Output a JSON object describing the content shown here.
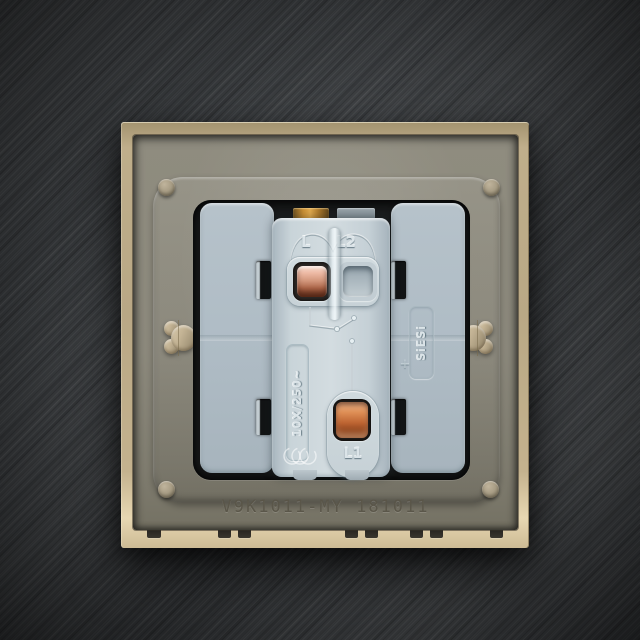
{
  "scene": {
    "description": "Rear view of a single 10A wall switch mechanism fitted in a champagne-gold face plate, photographed on dark brushed metal",
    "type": "product-photo"
  },
  "markings": {
    "terminal_top_left_label": "L",
    "terminal_top_right_label": "L2",
    "terminal_bottom_label": "L1",
    "rating_text": "10X/250~",
    "brand_text": "SiESi",
    "model_print": "V9K1011-MY 181011",
    "cross_mark": "+"
  },
  "icons": {
    "certification_mark": "ccc-certification-icon",
    "circuit_diagram": "two-way-switch-circuit-engraving"
  },
  "colors": {
    "background": "#3e4144",
    "frame_gold": "#c7b491",
    "mounting_plate": "#8c897d",
    "module_body": "#b2bfc8",
    "module_center": "#cdd7dc",
    "copper": "#c4754a",
    "slot_black": "#141617"
  }
}
